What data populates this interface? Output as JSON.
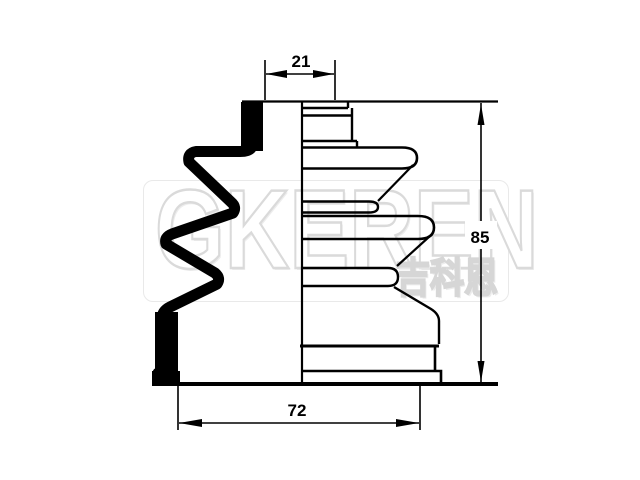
{
  "diagram": {
    "dimensions": {
      "top_width": "21",
      "height": "85",
      "bottom_width": "72"
    }
  },
  "watermark": {
    "brand": "GKEREN",
    "brand_cjk": "吉科恩"
  },
  "colors": {
    "line": "#000000",
    "background": "#ffffff",
    "watermark_outline": "#dadada"
  }
}
